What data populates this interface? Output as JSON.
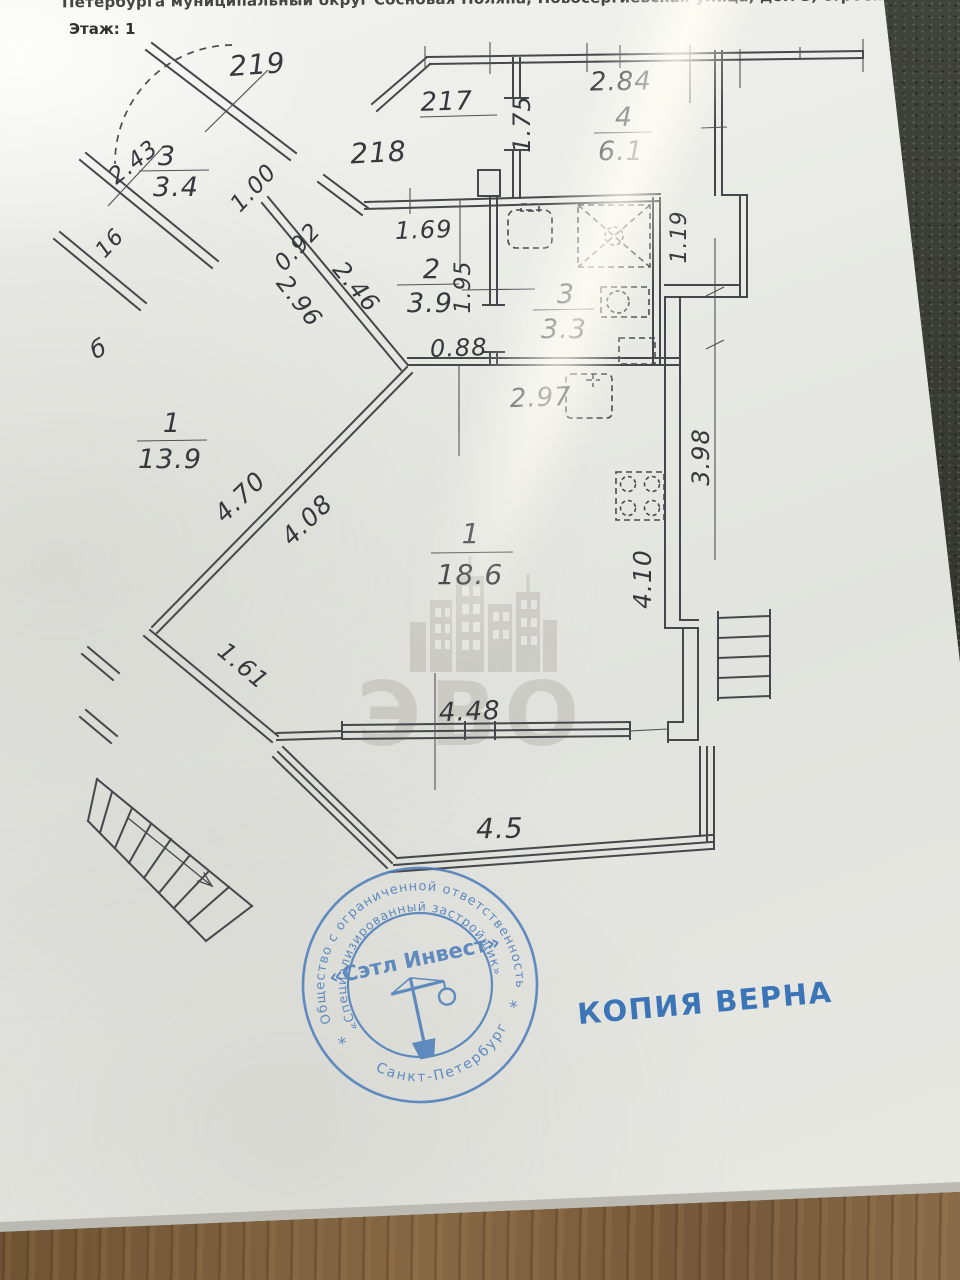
{
  "header": {
    "address": "Петербурга муниципальный округ Сосновая Поляна, Новосергиевская улица, дом 3, строение 1, кв. 218",
    "floor": "Этаж: 1"
  },
  "plan": {
    "corridor_labels": [
      {
        "text": "219"
      },
      {
        "text": "218"
      },
      {
        "text": "217"
      }
    ],
    "rooms": [
      {
        "number": "3",
        "area": "3.4"
      },
      {
        "number": "2",
        "area": "3.9"
      },
      {
        "number": "3",
        "area": "3.3"
      },
      {
        "number": "4",
        "area": "6.1"
      },
      {
        "number": "1",
        "area": "13.9"
      },
      {
        "number": "1",
        "area": "18.6"
      }
    ],
    "dims": {
      "w243": "2.43",
      "w100": "1.00",
      "w092": "0.92",
      "w169": "1.69",
      "w246": "2.46",
      "w296": "2.96",
      "w195": "1.95",
      "w088": "0.88",
      "w284": "2.84",
      "w175": "1.75",
      "w119": "1.19",
      "w297": "2.97",
      "w398": "3.98",
      "w470": "4.70",
      "w408": "4.08",
      "w410": "4.10",
      "w161": "1.61",
      "w448": "4.48",
      "w45": "4.5",
      "w16": "16",
      "glyph_b": "б"
    }
  },
  "watermark": {
    "text": "ЭВО"
  },
  "stamp": {
    "outer_top": "Общество с ограниченной ответственностью",
    "inner": "«Специализированный застройщик»",
    "center": "«Сэтл Инвест»",
    "bottom": "Санкт-Петербург",
    "star_left": "*",
    "star_right": "*",
    "ink_color": "#4a7cba"
  },
  "copy_note": "КОПИЯ ВЕРНА"
}
